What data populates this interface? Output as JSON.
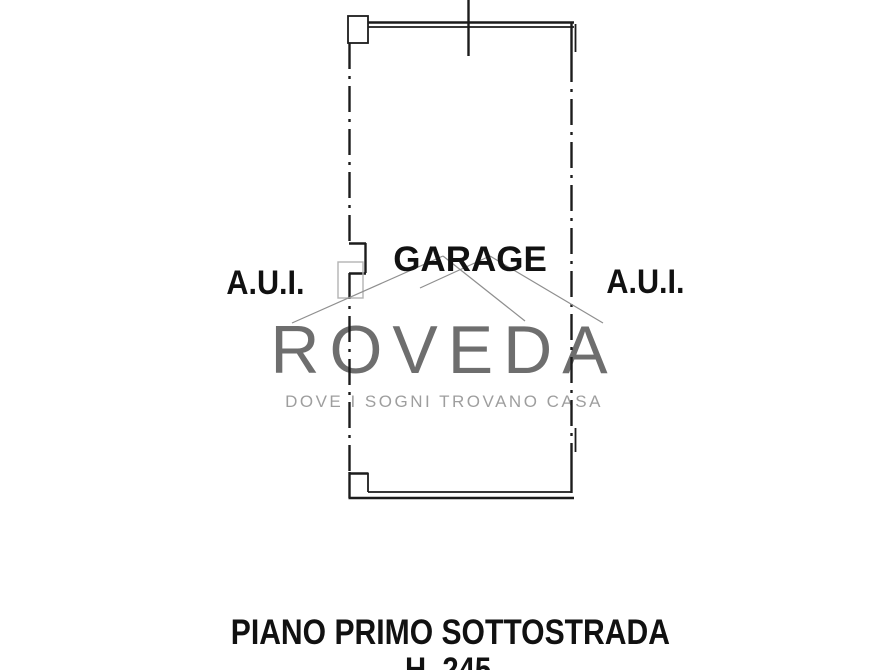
{
  "floorplan": {
    "rooms": {
      "garage_label": "GARAGE",
      "aui_left_label": "A.U.I.",
      "aui_right_label": "A.U.I."
    },
    "caption": {
      "title": "PIANO PRIMO SOTTOSTRADA",
      "height_note": "H. 245"
    },
    "watermark": {
      "brand": "ROVEDA",
      "tagline": "DOVE I SOGNI TROVANO CASA"
    },
    "colors": {
      "background": "#ffffff",
      "wall": "#1c1c1c",
      "label_text": "#111111",
      "leader_line": "#8f8f8f",
      "door_marker": "#b3b3b3",
      "watermark_brand": "#6e6e6e",
      "watermark_tagline": "#9e9e9e"
    }
  }
}
